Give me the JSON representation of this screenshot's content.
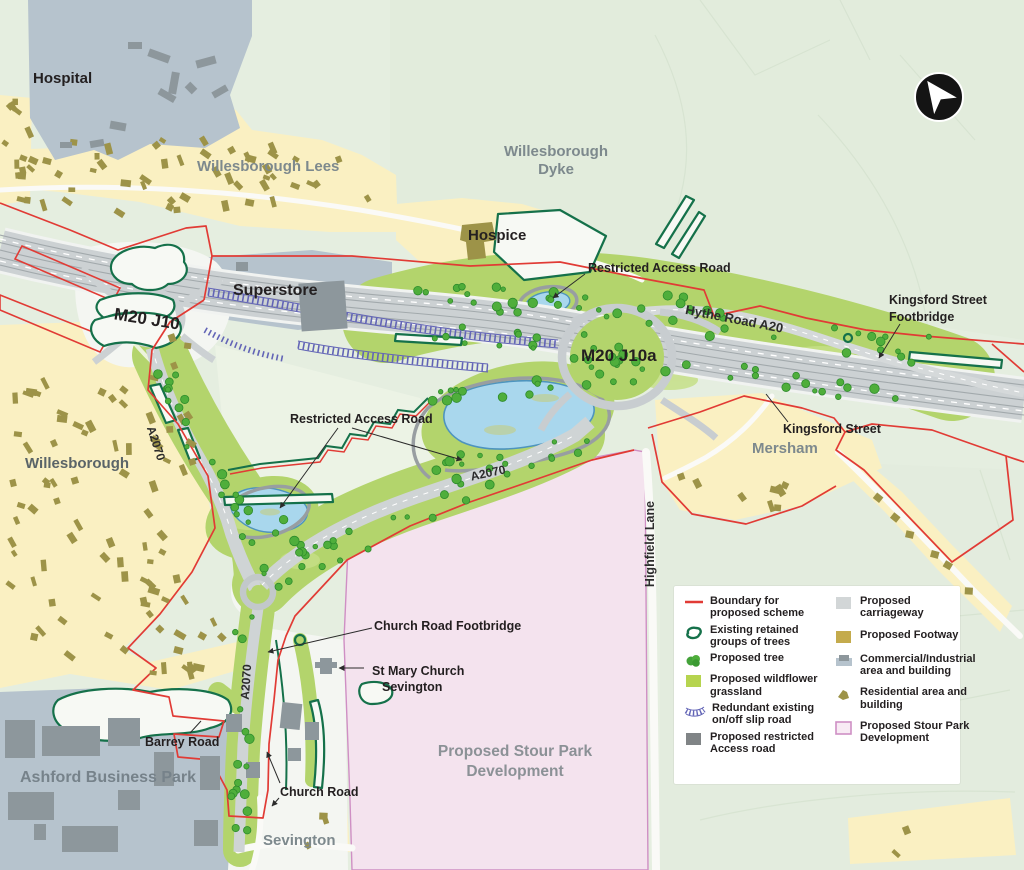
{
  "map_title": "M20 J10a scheme plan",
  "colors": {
    "boundary_red": "#e13b35",
    "grassland": "#b3d46c",
    "tree_green": "#4fae3b",
    "retained_green": "#15714a",
    "redundant_blue": "#6264b6",
    "carriageway_grey": "#ccd1d3",
    "footway_khaki": "#c4ab4d",
    "residential_yellow": "#faf0c2",
    "residential_building": "#9d9348",
    "commercial_bluegrey": "#b6c3cd",
    "commercial_building": "#8d979c",
    "stour_pink": "#f4e3ee",
    "stour_border": "#cf8fc4",
    "pond_blue": "#a9d7ed"
  },
  "places": {
    "hospital": "Hospital",
    "willesborough_lees": "Willesborough Lees",
    "willesborough_dyke_line1": "Willesborough",
    "willesborough_dyke_line2": "Dyke",
    "hospice": "Hospice",
    "superstore": "Superstore",
    "willesborough": "Willesborough",
    "mersham": "Mersham",
    "sevington": "Sevington",
    "ashford_business_park": "Ashford Business Park",
    "stour_park_line1": "Proposed Stour Park",
    "stour_park_line2": "Development"
  },
  "roads": {
    "m20_j10": "M20 J10",
    "m20_j10a": "M20 J10a",
    "hythe_road_a20": "Hythe Road A20",
    "a2070": "A2070",
    "highfield_lane": "Highfield Lane"
  },
  "annotations": {
    "restricted_access_road": "Restricted Access Road",
    "kingsford_footbridge_line1": "Kingsford Street",
    "kingsford_footbridge_line2": "Footbridge",
    "kingsford_street": "Kingsford Street",
    "church_road_footbridge": "Church Road Footbridge",
    "st_mary_line1": "St Mary Church",
    "st_mary_line2": "Sevington",
    "barrey_road": "Barrey Road",
    "church_road": "Church Road"
  },
  "legend": {
    "left": [
      "Boundary for proposed scheme",
      "Existing retained groups of trees",
      "Proposed tree",
      "Proposed wildflower grassland",
      "Redundant existing on/off slip road",
      "Proposed restricted Access road"
    ],
    "right": [
      "Proposed carriageway",
      "Proposed Footway",
      "Commercial/Industrial area and building",
      "Residential area and building",
      "Proposed Stour Park Development"
    ]
  }
}
